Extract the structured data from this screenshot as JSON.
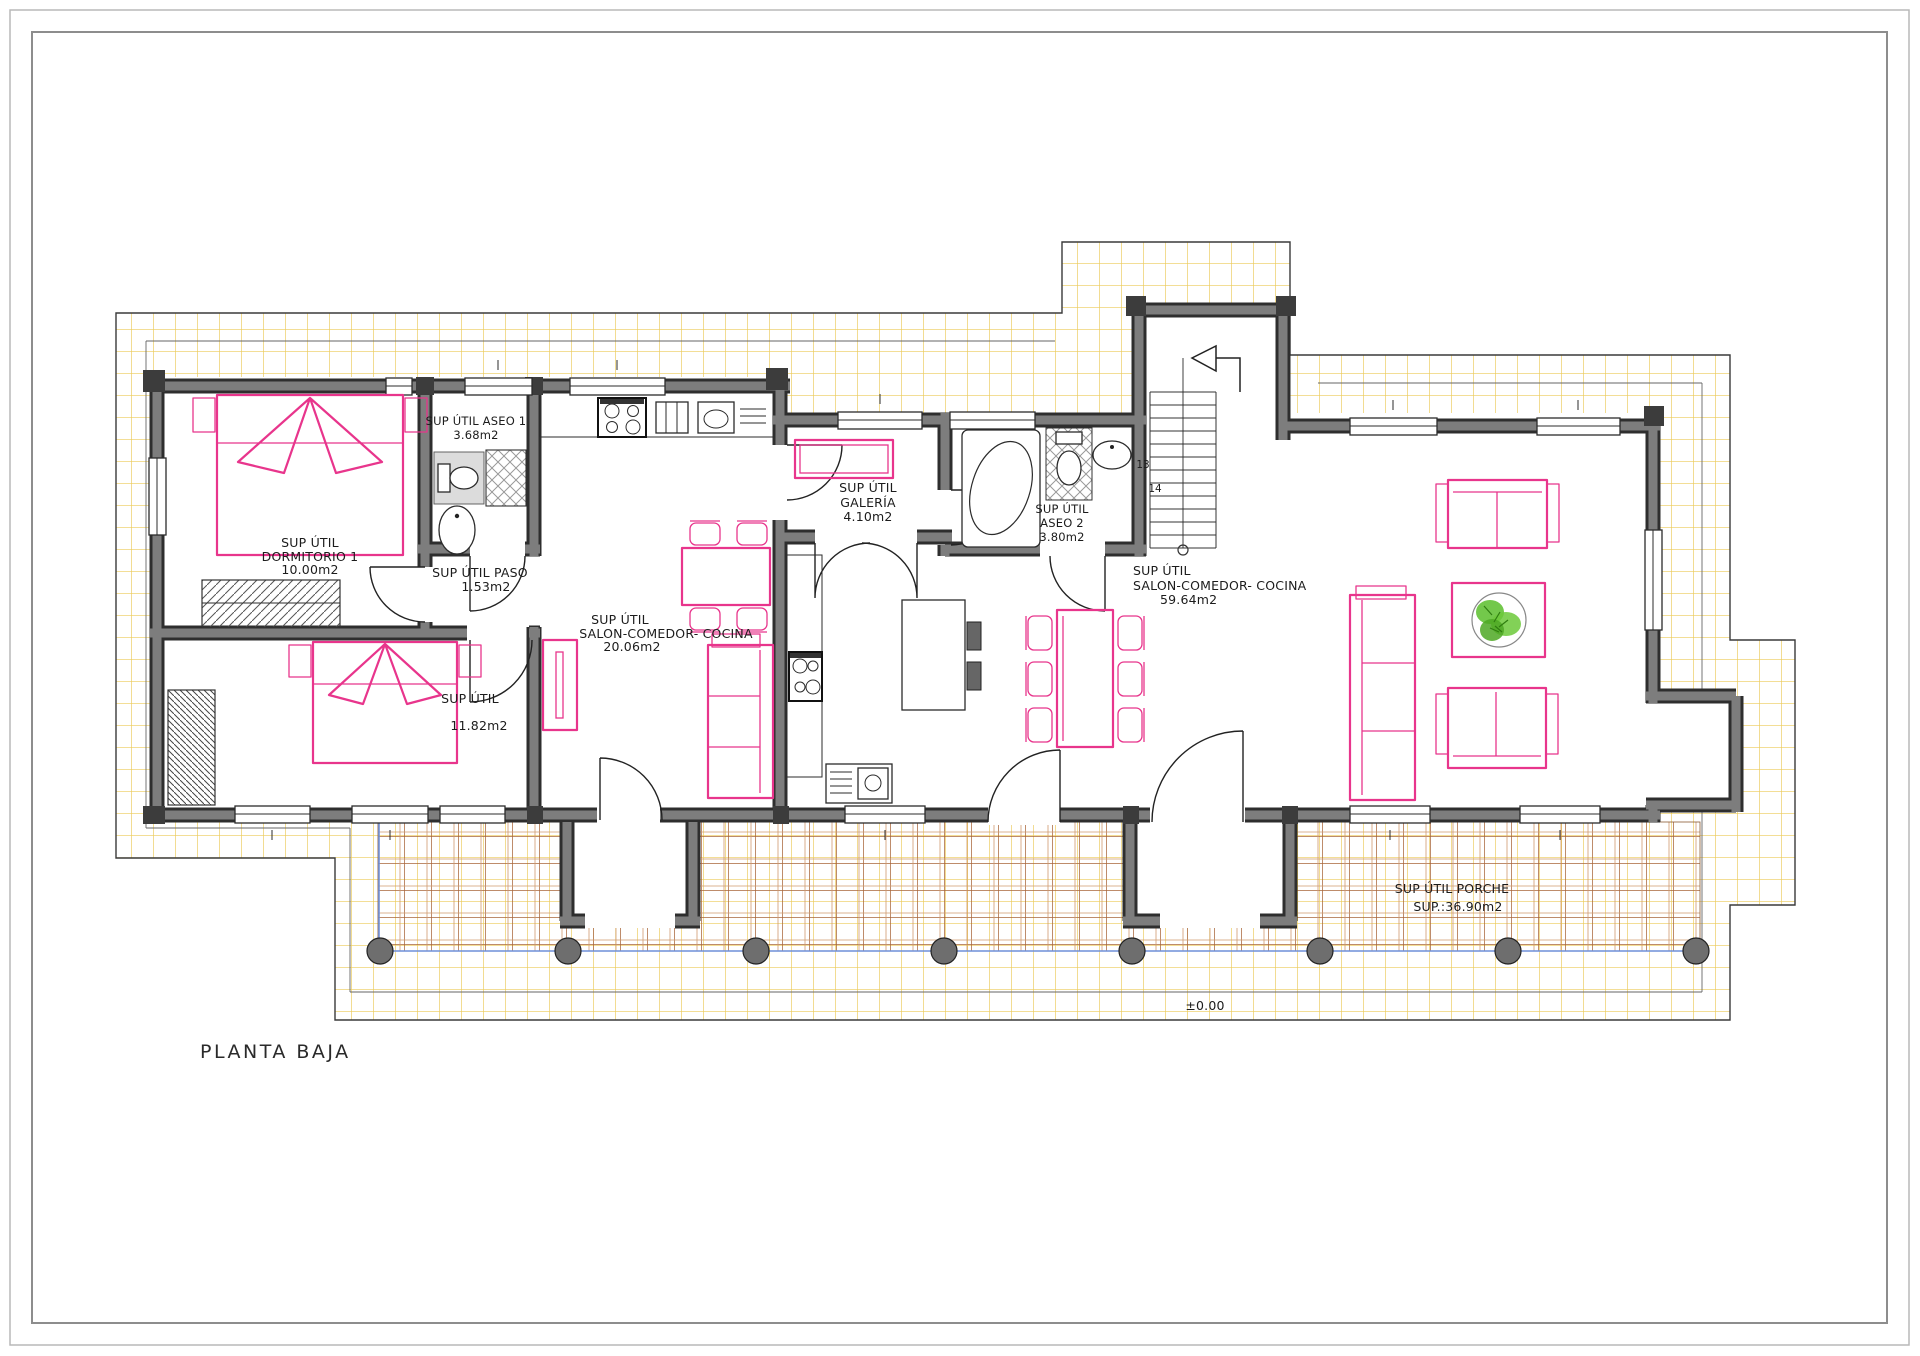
{
  "title": "PLANTA BAJA",
  "level_mark": "±0.00",
  "stairs": {
    "step_a": "13",
    "step_b": "14"
  },
  "rooms": {
    "dormitorio1": {
      "line1": "SUP ÚTIL",
      "line2": "DORMITORIO 1",
      "area": "10.00m2"
    },
    "aseo1": {
      "line1": "SUP ÚTIL ASEO 1",
      "area": "3.68m2"
    },
    "paso": {
      "line1": "SUP ÚTIL PASO",
      "area": "1.53m2"
    },
    "salon_cocina_1": {
      "line1": "SUP ÚTIL",
      "line2": "SALON-COMEDOR- COCINA",
      "area": "20.06m2"
    },
    "galeria": {
      "line1": "SUP ÚTIL",
      "line2": "GALERÍA",
      "area": "4.10m2"
    },
    "aseo2": {
      "line1": "SUP ÚTIL",
      "line2": "ASEO 2",
      "area": "3.80m2"
    },
    "dormitorio2": {
      "line1": "SUP ÚTIL",
      "line2": "DORMITORIO 2",
      "area": "11.82m2"
    },
    "salon_cocina_2": {
      "line1": "SUP ÚTIL",
      "line2": "SALON-COMEDOR- COCINA",
      "area": "59.64m2"
    },
    "porche": {
      "line1": "SUP ÚTIL PORCHE",
      "area": "SUP.:36.90m2"
    }
  },
  "colors": {
    "furniture_pink": "#e8358c",
    "tile_yellow": "#ecca58",
    "tile_porch": "#a8653a",
    "plant_green": "#5bbe2b",
    "porch_edge_blue": "#6f8fd8",
    "wall_gray": "#7d7d7d"
  }
}
